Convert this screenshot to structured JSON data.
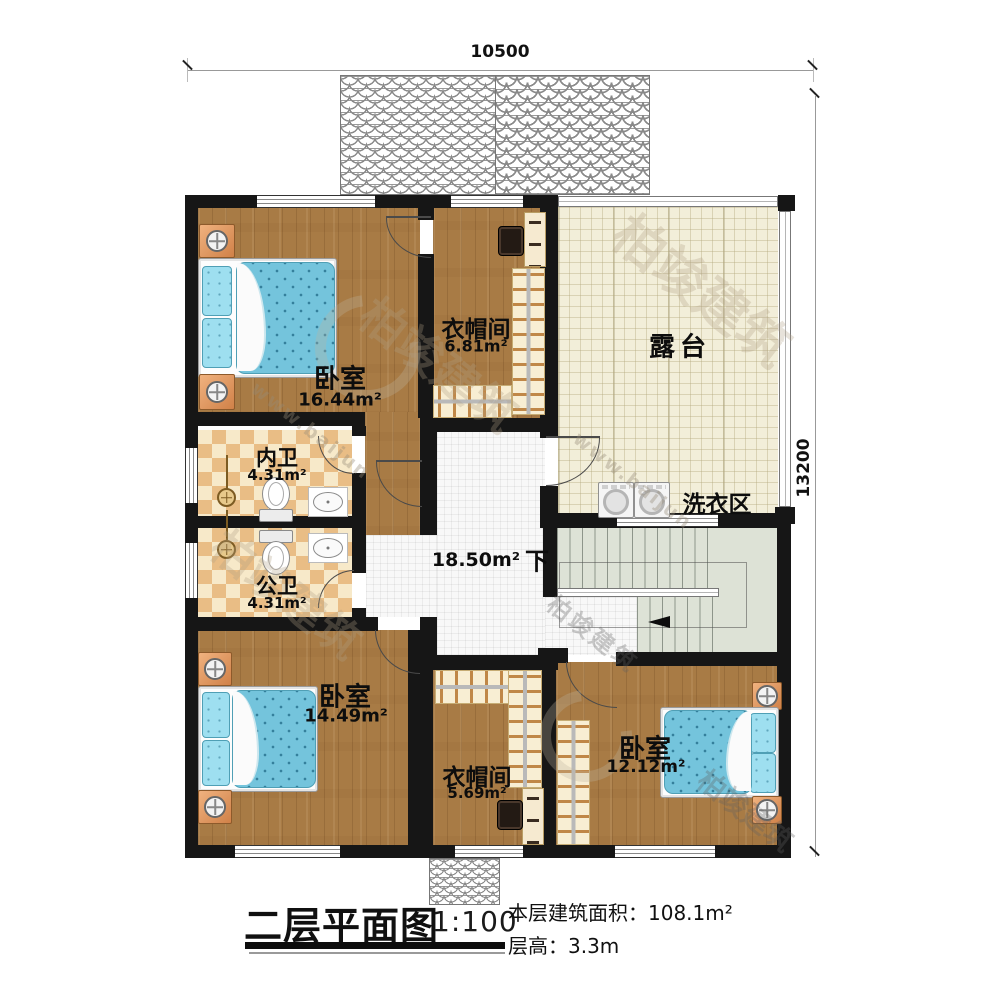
{
  "dimensions": {
    "top": "10500",
    "right": "13200"
  },
  "rooms": {
    "bedroom_tl": {
      "name": "卧室",
      "area": "16.44m²"
    },
    "closet_top": {
      "name": "衣帽间",
      "area": "6.81m²"
    },
    "terrace": {
      "name": "露台"
    },
    "bath_inner": {
      "name": "内卫",
      "area": "4.31m²"
    },
    "bath_public": {
      "name": "公卫",
      "area": "4.31m²"
    },
    "laundry": {
      "name": "洗衣区"
    },
    "hall": {
      "area": "18.50m²",
      "down": "下"
    },
    "bedroom_bl": {
      "name": "卧室",
      "area": "14.49m²"
    },
    "closet_bottom": {
      "name": "衣帽间",
      "area": "5.69m²"
    },
    "bedroom_br": {
      "name": "卧室",
      "area": "12.12m²"
    }
  },
  "title": {
    "name": "二层平面图",
    "scale": "1:100",
    "area_line": "本层建筑面积：108.1m²",
    "height_line": "层高：3.3m"
  },
  "watermark": {
    "brand": "柏竣建筑",
    "url": "www.baijun"
  },
  "palette": {
    "wall": "#161616",
    "wood_floor": "#a87b45",
    "bed_blue": "#74c4dc",
    "checker_tan": "#e9bd85",
    "checker_cream": "#f7e9c9",
    "terrace_floor": "#f2eed9",
    "hall_tile": "#f8f8f8",
    "stair_green": "#dde2d6",
    "nightstand_orange": "#d08148"
  }
}
